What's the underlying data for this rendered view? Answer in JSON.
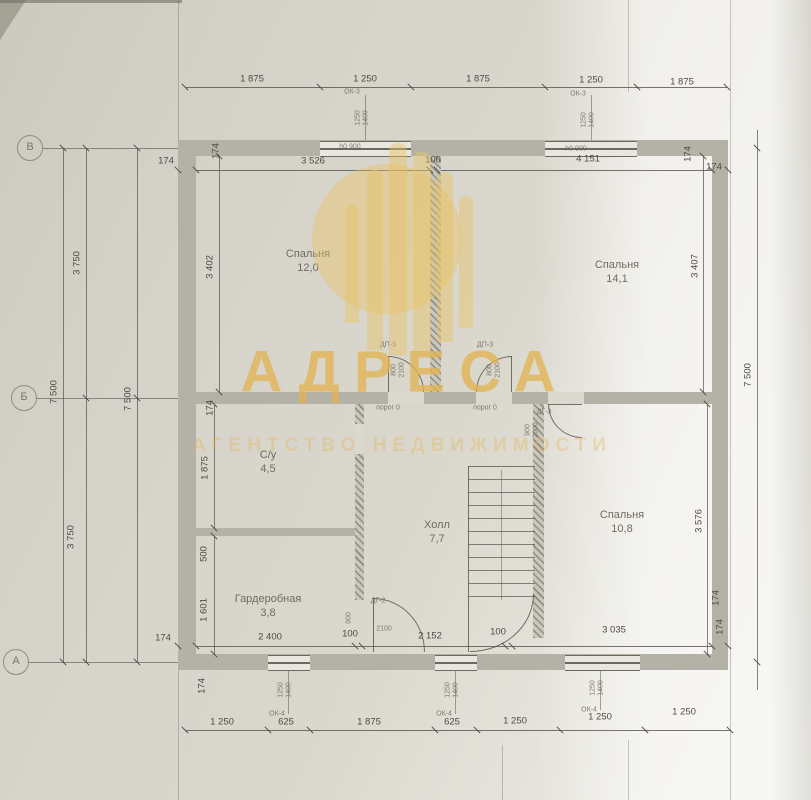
{
  "watermark": {
    "title": "АДРЕСА",
    "subtitle": "АГЕНТСТВО НЕДВИЖИМОСТИ",
    "gold_color": "#e9c464",
    "bars": [
      [
        345,
        205,
        14,
        118
      ],
      [
        367,
        170,
        16,
        180
      ],
      [
        389,
        143,
        18,
        212
      ],
      [
        413,
        152,
        18,
        200
      ],
      [
        437,
        172,
        16,
        170
      ],
      [
        459,
        196,
        14,
        132
      ]
    ]
  },
  "axis_markers": [
    {
      "label": "В",
      "x": 30,
      "y": 148
    },
    {
      "label": "Б",
      "x": 24,
      "y": 398
    },
    {
      "label": "А",
      "x": 16,
      "y": 662
    }
  ],
  "rooms": [
    {
      "name": "Спальня",
      "area": "12,0",
      "x": 308,
      "y": 247
    },
    {
      "name": "Спальня",
      "area": "14,1",
      "x": 617,
      "y": 258
    },
    {
      "name": "С/у",
      "area": "4,5",
      "x": 268,
      "y": 448
    },
    {
      "name": "Холл",
      "area": "7,7",
      "x": 437,
      "y": 518
    },
    {
      "name": "Спальня",
      "area": "10,8",
      "x": 622,
      "y": 508
    },
    {
      "name": "Гардеробная",
      "area": "3,8",
      "x": 268,
      "y": 592
    }
  ],
  "dim_labels": [
    {
      "t": "1 875",
      "x": 252,
      "y": 79
    },
    {
      "t": "1 250",
      "x": 365,
      "y": 79
    },
    {
      "t": "1 875",
      "x": 478,
      "y": 79
    },
    {
      "t": "1 250",
      "x": 591,
      "y": 80
    },
    {
      "t": "1 875",
      "x": 682,
      "y": 82
    },
    {
      "t": "174",
      "x": 166,
      "y": 161
    },
    {
      "t": "174",
      "x": 216,
      "y": 151,
      "r": 1
    },
    {
      "t": "3 526",
      "x": 313,
      "y": 161
    },
    {
      "t": "100",
      "x": 433,
      "y": 160
    },
    {
      "t": "4 151",
      "x": 588,
      "y": 159
    },
    {
      "t": "174",
      "x": 688,
      "y": 154,
      "r": 1
    },
    {
      "t": "174",
      "x": 714,
      "y": 167
    },
    {
      "t": "7 500",
      "x": 54,
      "y": 392,
      "r": 1
    },
    {
      "t": "3 750",
      "x": 77,
      "y": 263,
      "r": 1
    },
    {
      "t": "3 750",
      "x": 71,
      "y": 537,
      "r": 1
    },
    {
      "t": "7 500",
      "x": 128,
      "y": 399,
      "r": 1
    },
    {
      "t": "7 500",
      "x": 748,
      "y": 375,
      "r": 1
    },
    {
      "t": "3 402",
      "x": 210,
      "y": 267,
      "r": 1
    },
    {
      "t": "174",
      "x": 210,
      "y": 408,
      "r": 1
    },
    {
      "t": "1 875",
      "x": 205,
      "y": 468,
      "r": 1
    },
    {
      "t": "500",
      "x": 204,
      "y": 554,
      "r": 1
    },
    {
      "t": "1 601",
      "x": 204,
      "y": 610,
      "r": 1
    },
    {
      "t": "174",
      "x": 202,
      "y": 686,
      "r": 1
    },
    {
      "t": "3 407",
      "x": 695,
      "y": 266,
      "r": 1
    },
    {
      "t": "3 576",
      "x": 699,
      "y": 521,
      "r": 1
    },
    {
      "t": "174",
      "x": 716,
      "y": 598,
      "r": 1
    },
    {
      "t": "174",
      "x": 163,
      "y": 638
    },
    {
      "t": "2 400",
      "x": 270,
      "y": 637
    },
    {
      "t": "100",
      "x": 350,
      "y": 634
    },
    {
      "t": "2 152",
      "x": 430,
      "y": 636
    },
    {
      "t": "100",
      "x": 498,
      "y": 632
    },
    {
      "t": "3 035",
      "x": 614,
      "y": 630
    },
    {
      "t": "174",
      "x": 720,
      "y": 627,
      "r": 1
    },
    {
      "t": "1 250",
      "x": 222,
      "y": 722
    },
    {
      "t": "625",
      "x": 286,
      "y": 722
    },
    {
      "t": "1 875",
      "x": 369,
      "y": 722
    },
    {
      "t": "625",
      "x": 452,
      "y": 722
    },
    {
      "t": "1 250",
      "x": 515,
      "y": 721
    },
    {
      "t": "1 250",
      "x": 600,
      "y": 717
    },
    {
      "t": "1 250",
      "x": 684,
      "y": 712
    }
  ],
  "annotations": [
    {
      "t": "ОК-3",
      "x": 352,
      "y": 92
    },
    {
      "t": "1250",
      "x": 358,
      "y": 118,
      "r": 1
    },
    {
      "t": "1400",
      "x": 366,
      "y": 118,
      "r": 1
    },
    {
      "t": "h0 900",
      "x": 350,
      "y": 147
    },
    {
      "t": "ОК-3",
      "x": 578,
      "y": 94
    },
    {
      "t": "1250",
      "x": 584,
      "y": 120,
      "r": 1
    },
    {
      "t": "1400",
      "x": 592,
      "y": 120,
      "r": 1
    },
    {
      "t": "h0 900",
      "x": 576,
      "y": 149
    },
    {
      "t": "1250",
      "x": 281,
      "y": 690,
      "r": 1
    },
    {
      "t": "1400",
      "x": 289,
      "y": 690,
      "r": 1
    },
    {
      "t": "ОК-4",
      "x": 277,
      "y": 714
    },
    {
      "t": "1250",
      "x": 448,
      "y": 690,
      "r": 1
    },
    {
      "t": "1400",
      "x": 456,
      "y": 690,
      "r": 1
    },
    {
      "t": "ОК-4",
      "x": 444,
      "y": 714
    },
    {
      "t": "1250",
      "x": 593,
      "y": 688,
      "r": 1
    },
    {
      "t": "1400",
      "x": 601,
      "y": 688,
      "r": 1
    },
    {
      "t": "ОК-4",
      "x": 589,
      "y": 710
    },
    {
      "t": "ДП-3",
      "x": 388,
      "y": 345
    },
    {
      "t": "800",
      "x": 394,
      "y": 370,
      "r": 1
    },
    {
      "t": "2100",
      "x": 402,
      "y": 370,
      "r": 1
    },
    {
      "t": "порог 0",
      "x": 388,
      "y": 408
    },
    {
      "t": "ДП-3",
      "x": 485,
      "y": 345
    },
    {
      "t": "800",
      "x": 490,
      "y": 370,
      "r": 1
    },
    {
      "t": "2100",
      "x": 498,
      "y": 370,
      "r": 1
    },
    {
      "t": "порог 0",
      "x": 485,
      "y": 408
    },
    {
      "t": "ДГ-3",
      "x": 544,
      "y": 412
    },
    {
      "t": "900",
      "x": 528,
      "y": 430,
      "r": 1
    },
    {
      "t": "2000",
      "x": 536,
      "y": 430,
      "r": 1
    },
    {
      "t": "ДГ-2",
      "x": 378,
      "y": 601
    },
    {
      "t": "900",
      "x": 349,
      "y": 618,
      "r": 1
    },
    {
      "t": "2100",
      "x": 384,
      "y": 629
    }
  ],
  "geometry": {
    "lines": [
      [
        178,
        0,
        1,
        800,
        0.3
      ],
      [
        730,
        0,
        1,
        800,
        0.3
      ],
      [
        628,
        0,
        1,
        92,
        0.3
      ],
      [
        628,
        740,
        1,
        60,
        0.3
      ],
      [
        502,
        745,
        1,
        55,
        0.3
      ],
      [
        43,
        148,
        135,
        1,
        0.6
      ],
      [
        37,
        398,
        159,
        1,
        0.6
      ],
      [
        29,
        662,
        149,
        1,
        0.6
      ],
      [
        63,
        148,
        1,
        514,
        0.7
      ],
      [
        86,
        148,
        1,
        514,
        0.7
      ],
      [
        137,
        148,
        1,
        514,
        0.7
      ],
      [
        757,
        130,
        1,
        560,
        0.7
      ],
      [
        185,
        87,
        542,
        1,
        0.8
      ],
      [
        178,
        170,
        550,
        1,
        0.8
      ],
      [
        178,
        646,
        550,
        1,
        0.8
      ],
      [
        185,
        730,
        545,
        1,
        0.8
      ],
      [
        219,
        156,
        1,
        248,
        0.7
      ],
      [
        214,
        404,
        1,
        250,
        0.7
      ],
      [
        703,
        156,
        1,
        236,
        0.7
      ],
      [
        707,
        404,
        1,
        250,
        0.7
      ],
      [
        365,
        95,
        1,
        47,
        0.5
      ],
      [
        591,
        95,
        1,
        47,
        0.5
      ],
      [
        288,
        668,
        1,
        46,
        0.5
      ],
      [
        455,
        668,
        1,
        46,
        0.5
      ],
      [
        600,
        668,
        1,
        42,
        0.5
      ],
      [
        468,
        466,
        1,
        186,
        0.8
      ],
      [
        501,
        470,
        1,
        130,
        0.45
      ],
      [
        388,
        356,
        1,
        36,
        0.8
      ],
      [
        511,
        356,
        1,
        36,
        0.8
      ],
      [
        548,
        404,
        34,
        1,
        0.8
      ],
      [
        373,
        598,
        1,
        54,
        0.8
      ]
    ],
    "ticks": [
      [
        185,
        87
      ],
      [
        320,
        87
      ],
      [
        411,
        87
      ],
      [
        545,
        87
      ],
      [
        637,
        87
      ],
      [
        727,
        87
      ],
      [
        178,
        170
      ],
      [
        196,
        170
      ],
      [
        430,
        170
      ],
      [
        437,
        170
      ],
      [
        712,
        170
      ],
      [
        728,
        170
      ],
      [
        178,
        646
      ],
      [
        196,
        646
      ],
      [
        355,
        646
      ],
      [
        362,
        646
      ],
      [
        505,
        646
      ],
      [
        512,
        646
      ],
      [
        712,
        646
      ],
      [
        728,
        646
      ],
      [
        185,
        730
      ],
      [
        268,
        730
      ],
      [
        310,
        730
      ],
      [
        435,
        730
      ],
      [
        477,
        730
      ],
      [
        560,
        730
      ],
      [
        645,
        730
      ],
      [
        730,
        730
      ],
      [
        63,
        148
      ],
      [
        63,
        662
      ],
      [
        86,
        148
      ],
      [
        86,
        398
      ],
      [
        86,
        662
      ],
      [
        137,
        148
      ],
      [
        137,
        398
      ],
      [
        137,
        662
      ],
      [
        757,
        148
      ],
      [
        757,
        662
      ],
      [
        219,
        156
      ],
      [
        219,
        392
      ],
      [
        214,
        404
      ],
      [
        214,
        528
      ],
      [
        214,
        536
      ],
      [
        214,
        654
      ],
      [
        703,
        156
      ],
      [
        703,
        392
      ],
      [
        707,
        404
      ],
      [
        707,
        654
      ]
    ],
    "walls": [
      [
        178,
        140,
        550,
        16,
        0
      ],
      [
        178,
        654,
        550,
        16,
        0
      ],
      [
        178,
        140,
        18,
        530,
        0
      ],
      [
        712,
        140,
        16,
        530,
        0
      ],
      [
        196,
        392,
        516,
        12,
        0
      ],
      [
        196,
        528,
        168,
        8,
        0
      ],
      [
        430,
        156,
        11,
        236,
        1
      ],
      [
        355,
        404,
        9,
        196,
        1
      ],
      [
        533,
        404,
        11,
        234,
        1
      ]
    ],
    "windows": [
      [
        320,
        141,
        91,
        14
      ],
      [
        545,
        141,
        92,
        14
      ],
      [
        268,
        655,
        42,
        14
      ],
      [
        435,
        655,
        42,
        14
      ],
      [
        565,
        655,
        75,
        14
      ]
    ],
    "door_gaps": [
      [
        388,
        392,
        36,
        12
      ],
      [
        476,
        392,
        36,
        12
      ],
      [
        548,
        392,
        36,
        12
      ],
      [
        355,
        424,
        9,
        30
      ]
    ],
    "arcs": [
      [
        388,
        356,
        36,
        36,
        "tr",
        "tr"
      ],
      [
        476,
        356,
        36,
        36,
        "tl",
        "tl"
      ],
      [
        548,
        404,
        34,
        34,
        "bl",
        "lb"
      ],
      [
        373,
        598,
        52,
        54,
        "tr",
        "tr"
      ],
      [
        470,
        594,
        64,
        58,
        "br",
        "rb"
      ]
    ]
  }
}
